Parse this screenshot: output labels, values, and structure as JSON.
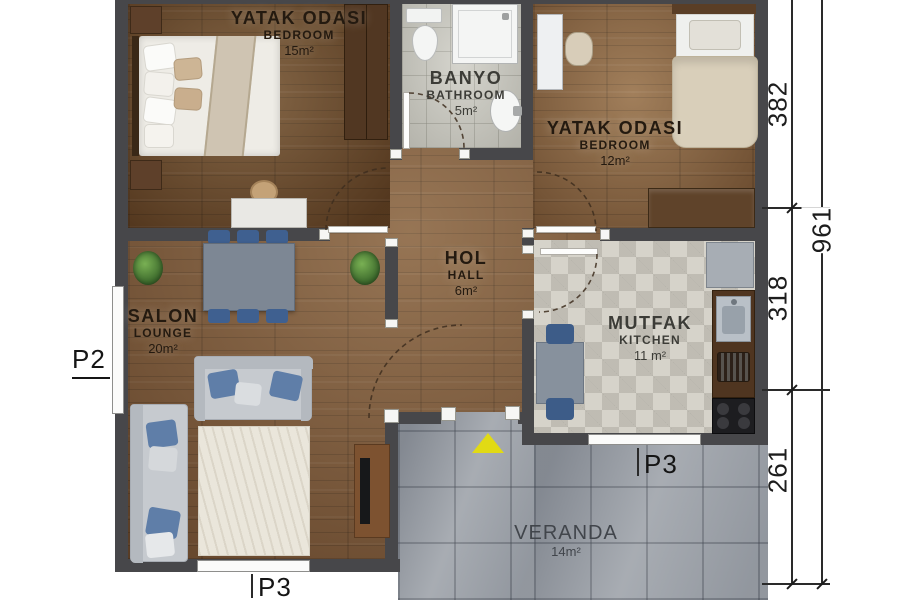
{
  "plan": {
    "rooms": {
      "bedroom1": {
        "title": "YATAK ODASI",
        "subtitle": "BEDROOM",
        "area": "15m²"
      },
      "bathroom": {
        "title": "BANYO",
        "subtitle": "BATHROOM",
        "area": "5m²"
      },
      "bedroom2": {
        "title": "YATAK ODASI",
        "subtitle": "BEDROOM",
        "area": "12m²"
      },
      "hall": {
        "title": "HOL",
        "subtitle": "HALL",
        "area": "6m²"
      },
      "lounge": {
        "title": "SALON",
        "subtitle": "LOUNGE",
        "area": "20m²"
      },
      "kitchen": {
        "title": "MUTFAK",
        "subtitle": "KITCHEN",
        "area": "11 m²"
      },
      "veranda": {
        "title": "VERANDA",
        "area": "14m²"
      }
    },
    "markers": {
      "p2": "P2",
      "p3_lounge": "P3",
      "p3_kitchen": "P3"
    },
    "dimensions": {
      "segments": [
        "382",
        "318",
        "261"
      ],
      "overall": "961"
    },
    "colors": {
      "wall": "#47474a",
      "wood": "#7d5838",
      "bath_tile": "#c8c7bf",
      "kitchen_tile": "#d6d3ca",
      "veranda_concrete": "#9ea3aa",
      "accent_blue": "#4a6b96",
      "entrance_arrow": "#e1da14"
    }
  }
}
